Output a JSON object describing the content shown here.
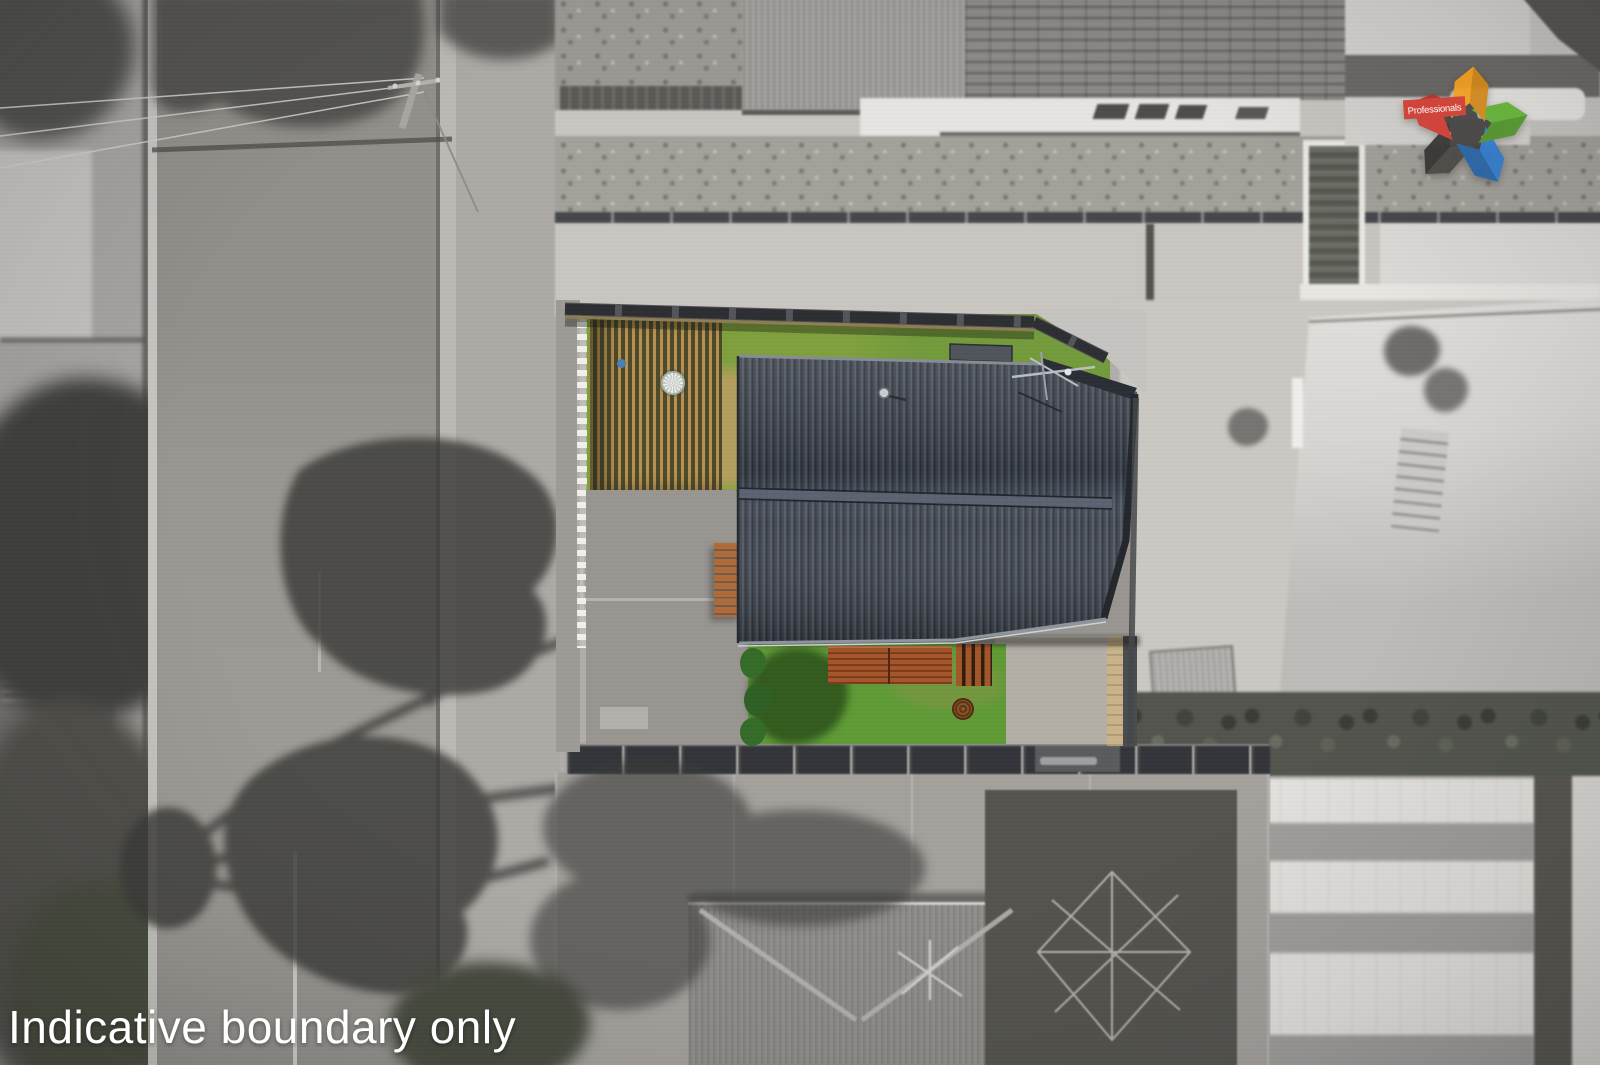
{
  "watermark": {
    "text": "Indicative boundary only"
  },
  "logo": {
    "brand": "Professionals"
  },
  "palette": {
    "asphalt": "#92908b",
    "asphalt_light": "#a09c97",
    "curb": "#c8c6c2",
    "verge": "#adaaa6",
    "concrete": "#c9c6c2",
    "concrete_bright": "#e7e5e1",
    "concrete_mid": "#a6a39f",
    "lawn_gray": "#a3a19a",
    "fence_gray": "#4a4a47",
    "shadow": "#3a3a37",
    "house_roof": "#3d434d",
    "roof_ridge": "#5d6472",
    "lawn_back": "#7fa03e",
    "lawn_front": "#5f9b37",
    "slat_timber": "#b8914f",
    "slat_gap": "#4d4a2c",
    "deck_timber": "#a4552a",
    "deck_dark": "#7c3c1c",
    "white_fence": "#f1f0ed",
    "tan_fence": "#c9b38b",
    "patio": "#b3aea6",
    "drive": "#999692",
    "manhole": "#7a4a22",
    "shrub": "#356b27",
    "big_roof1": "#d8d6d2",
    "big_roof2": "#e4e2de",
    "roof_stripe": "#a09e9b",
    "hedge": "#52544d",
    "ground_dark": "#54534e",
    "hip_roof": "#8e8c88",
    "logo_red": "#d03c31",
    "logo_orange": "#f29d1e",
    "logo_green": "#5fae33",
    "logo_blue": "#3079cb",
    "logo_gray": "#4a4946",
    "logo_core": "#3c3b39",
    "watermark": "#ffffff"
  }
}
